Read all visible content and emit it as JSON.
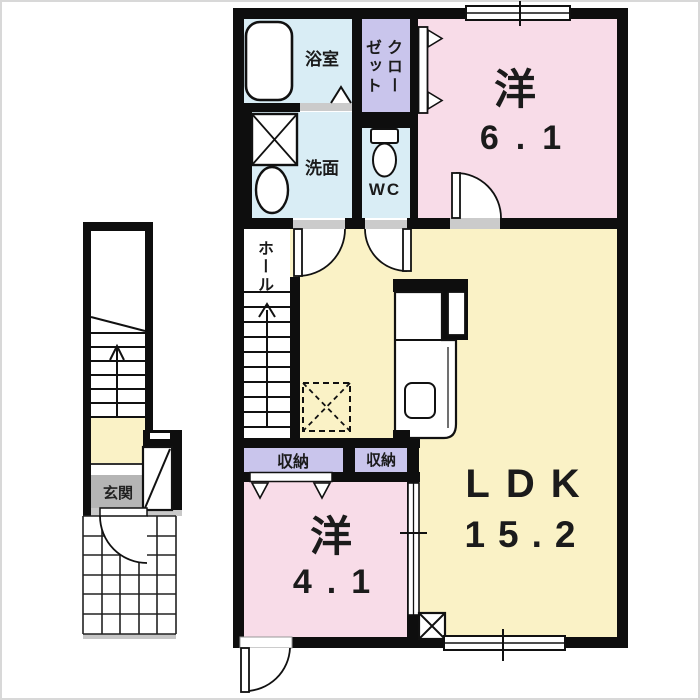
{
  "plan_type": "apartment-floor-plan",
  "rooms": {
    "bath": {
      "label": "浴室"
    },
    "washroom": {
      "label": "洗面"
    },
    "closet": {
      "full": "クローゼット",
      "col1": "クロー",
      "col2": "ゼット"
    },
    "wc": {
      "label": "WC"
    },
    "hall": {
      "label": "ホール"
    },
    "bedroom1": {
      "name": "洋",
      "size": "6.1"
    },
    "bedroom2": {
      "name": "洋",
      "size": "4.1"
    },
    "ldk": {
      "name": "LDK",
      "size": "15.2"
    },
    "storage_left": {
      "label": "収納"
    },
    "storage_right": {
      "label": "収納"
    },
    "entrance": {
      "label": "玄関"
    }
  },
  "colors": {
    "room_pink": "#f8dce8",
    "room_yellow": "#faf2c6",
    "wet_area_blue": "#d9edf5",
    "closet_lavender": "#c9c5ec",
    "entrance_gray": "#b5b5b5",
    "wall_black": "#0e0e0e",
    "sill_gray": "#cbcbcb"
  }
}
